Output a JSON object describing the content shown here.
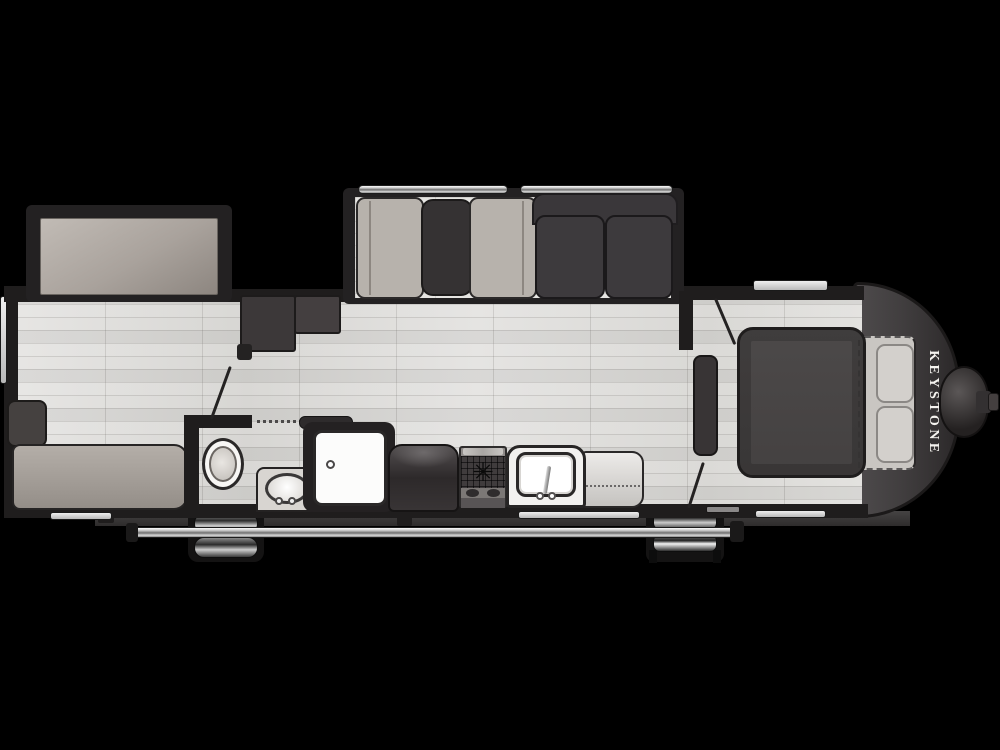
{
  "floorplan": {
    "title": "Keystone travel trailer floor plan (top-down)",
    "brand_label": "KEYSTONE",
    "range_burner_icon": "✳",
    "colors": {
      "background": "#000000",
      "walls": "#1f1d1d",
      "floor": "#e0dfdc",
      "dark_furniture": "#3d3a3d",
      "light_furniture": "#b7b2ac",
      "fixture_white": "#fbfbfa",
      "front_cap": "#3a3738",
      "brand_text": "#f5f3ef"
    },
    "rooms": {
      "rear_left": [
        "rear-slide-bunk",
        "sofa",
        "sofa-armrest"
      ],
      "bathroom": [
        "toilet",
        "vanity-sink",
        "shower",
        "pocket-door",
        "bath-door-swing"
      ],
      "main_slide": [
        "dinette-bench",
        "dinette-table",
        "dinette-bench",
        "theater-sofa"
      ],
      "kitchen": [
        "refrigerator",
        "range-cooktop",
        "kitchen-sink",
        "counter-extension"
      ],
      "bedroom": [
        "wardrobe",
        "queen-bed",
        "pillows",
        "bedroom-door-swing"
      ],
      "exterior": [
        "awning-rail",
        "tandem-wheels",
        "entry-steps",
        "entry-door-swing",
        "a-frame-hitch",
        "front-cap",
        "windows"
      ]
    }
  }
}
